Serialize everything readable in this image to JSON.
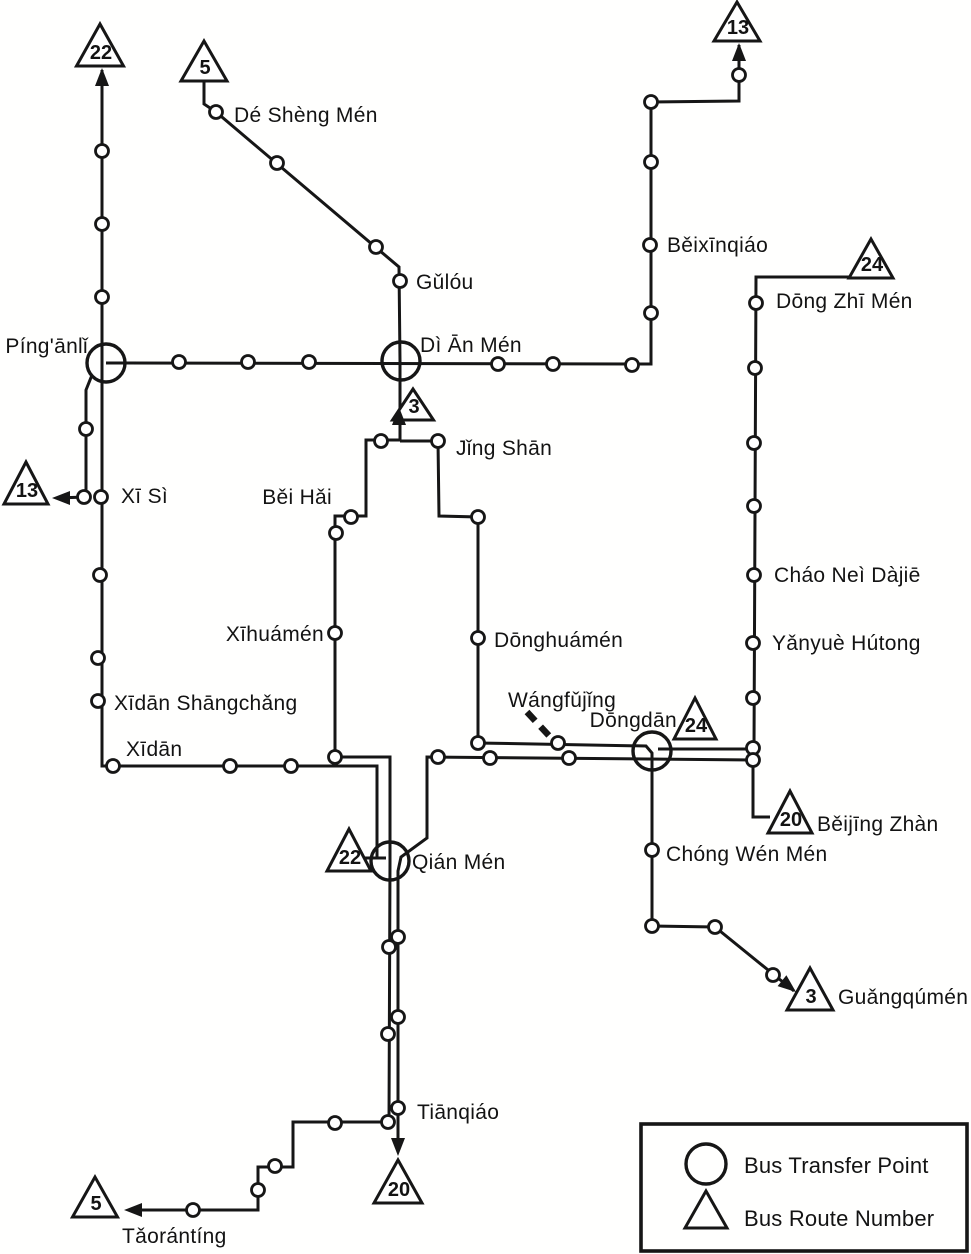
{
  "title": "Beijing Bus Routes Map",
  "ink_color": "#161616",
  "legend": {
    "transfer_label": "Bus Transfer Point",
    "route_label": "Bus Route Number",
    "box": {
      "x": 641,
      "y": 1124,
      "w": 326,
      "h": 127
    },
    "circle": {
      "x": 706,
      "y": 1164,
      "r": 20
    },
    "triangle": {
      "cx": 706,
      "base_y": 1228,
      "w": 42,
      "h": 37
    },
    "transfer_text_pos": {
      "x": 744,
      "y": 1173
    },
    "route_text_pos": {
      "x": 744,
      "y": 1226
    }
  },
  "map": {
    "width": 971,
    "height": 1254,
    "lines": [
      {
        "id": "route-22-main",
        "points": [
          [
            102,
            70
          ],
          [
            102,
            766
          ],
          [
            377,
            766
          ],
          [
            377,
            858
          ]
        ]
      },
      {
        "id": "route-22-qianmen-tick",
        "points": [
          [
            358,
            858
          ],
          [
            386,
            858
          ]
        ]
      },
      {
        "id": "route-5-north",
        "points": [
          [
            204,
            82
          ],
          [
            204,
            104
          ],
          [
            216,
            112
          ],
          [
            399,
            267
          ],
          [
            400,
            361
          ],
          [
            400,
            441
          ]
        ]
      },
      {
        "id": "route-5-south",
        "points": [
          [
            400,
            440
          ],
          [
            366,
            440
          ],
          [
            366,
            516
          ],
          [
            335,
            516
          ],
          [
            335,
            757
          ],
          [
            390,
            757
          ],
          [
            390,
            861
          ],
          [
            389,
            1122
          ],
          [
            293,
            1122
          ],
          [
            293,
            1167
          ],
          [
            258,
            1167
          ],
          [
            258,
            1210
          ],
          [
            128,
            1210
          ]
        ]
      },
      {
        "id": "route-3",
        "points": [
          [
            400,
            441
          ],
          [
            438,
            441
          ],
          [
            439,
            516
          ],
          [
            478,
            517
          ],
          [
            478,
            743
          ],
          [
            646,
            746
          ],
          [
            652,
            753
          ],
          [
            652,
            926
          ],
          [
            715,
            927
          ],
          [
            794,
            991
          ]
        ]
      },
      {
        "id": "route-20",
        "points": [
          [
            770,
            817
          ],
          [
            753,
            817
          ],
          [
            753,
            760
          ],
          [
            427,
            757
          ],
          [
            427,
            838
          ],
          [
            401,
            857
          ],
          [
            398,
            871
          ],
          [
            398,
            1150
          ]
        ]
      },
      {
        "id": "route-24",
        "points": [
          [
            849,
            277
          ],
          [
            756,
            277
          ],
          [
            754,
            749
          ],
          [
            658,
            749
          ]
        ]
      },
      {
        "id": "route-13-main",
        "points": [
          [
            739,
            45
          ],
          [
            739,
            101
          ],
          [
            651,
            102
          ],
          [
            651,
            364
          ],
          [
            106,
            363
          ]
        ]
      },
      {
        "id": "route-13-west-branch",
        "points": [
          [
            92,
            375
          ],
          [
            86,
            390
          ],
          [
            86,
            497
          ],
          [
            56,
            498
          ]
        ]
      }
    ],
    "dashes": [
      {
        "id": "wangfujing-pointer",
        "points": [
          [
            527,
            712
          ],
          [
            553,
            740
          ]
        ]
      }
    ],
    "stops": [
      {
        "x": 102,
        "y": 151
      },
      {
        "x": 102,
        "y": 224
      },
      {
        "x": 102,
        "y": 297
      },
      {
        "x": 179,
        "y": 362
      },
      {
        "x": 248,
        "y": 362
      },
      {
        "x": 309,
        "y": 362
      },
      {
        "x": 498,
        "y": 364
      },
      {
        "x": 553,
        "y": 364
      },
      {
        "x": 632,
        "y": 365
      },
      {
        "x": 216,
        "y": 112
      },
      {
        "x": 277,
        "y": 163
      },
      {
        "x": 376,
        "y": 247
      },
      {
        "x": 400,
        "y": 281
      },
      {
        "x": 739,
        "y": 75
      },
      {
        "x": 651,
        "y": 102
      },
      {
        "x": 651,
        "y": 162
      },
      {
        "x": 650,
        "y": 245
      },
      {
        "x": 651,
        "y": 313
      },
      {
        "x": 756,
        "y": 303
      },
      {
        "x": 755,
        "y": 368
      },
      {
        "x": 754,
        "y": 443
      },
      {
        "x": 754,
        "y": 506
      },
      {
        "x": 754,
        "y": 575
      },
      {
        "x": 753,
        "y": 643
      },
      {
        "x": 753,
        "y": 698
      },
      {
        "x": 753,
        "y": 748
      },
      {
        "x": 753,
        "y": 760
      },
      {
        "x": 86,
        "y": 429
      },
      {
        "x": 84,
        "y": 497
      },
      {
        "x": 101,
        "y": 497
      },
      {
        "x": 100,
        "y": 575
      },
      {
        "x": 98,
        "y": 658
      },
      {
        "x": 98,
        "y": 701
      },
      {
        "x": 113,
        "y": 766
      },
      {
        "x": 230,
        "y": 766
      },
      {
        "x": 291,
        "y": 766
      },
      {
        "x": 381,
        "y": 441
      },
      {
        "x": 438,
        "y": 441
      },
      {
        "x": 351,
        "y": 517
      },
      {
        "x": 478,
        "y": 517
      },
      {
        "x": 336,
        "y": 533
      },
      {
        "x": 335,
        "y": 633
      },
      {
        "x": 478,
        "y": 638
      },
      {
        "x": 335,
        "y": 757
      },
      {
        "x": 478,
        "y": 743
      },
      {
        "x": 558,
        "y": 743
      },
      {
        "x": 438,
        "y": 757
      },
      {
        "x": 490,
        "y": 758
      },
      {
        "x": 569,
        "y": 758
      },
      {
        "x": 398,
        "y": 937
      },
      {
        "x": 389,
        "y": 947
      },
      {
        "x": 398,
        "y": 1017
      },
      {
        "x": 388,
        "y": 1034
      },
      {
        "x": 398,
        "y": 1108
      },
      {
        "x": 388,
        "y": 1122
      },
      {
        "x": 335,
        "y": 1123
      },
      {
        "x": 275,
        "y": 1166
      },
      {
        "x": 258,
        "y": 1190
      },
      {
        "x": 193,
        "y": 1210
      },
      {
        "x": 652,
        "y": 850
      },
      {
        "x": 652,
        "y": 926
      },
      {
        "x": 715,
        "y": 927
      },
      {
        "x": 773,
        "y": 975
      }
    ],
    "transfers": [
      {
        "id": "pinganli",
        "x": 106,
        "y": 363,
        "r": 19
      },
      {
        "id": "dianmen",
        "x": 401,
        "y": 361,
        "r": 19
      },
      {
        "id": "dongdan",
        "x": 652,
        "y": 751,
        "r": 19
      },
      {
        "id": "qianmen",
        "x": 390,
        "y": 861,
        "r": 19
      }
    ],
    "triangles": [
      {
        "id": "route-22-north-end",
        "cx": 100,
        "base_y": 66,
        "w": 47,
        "h": 42,
        "num": "22"
      },
      {
        "id": "route-5-north-end",
        "cx": 204,
        "base_y": 81,
        "w": 46,
        "h": 40,
        "num": "5"
      },
      {
        "id": "route-13-north-end",
        "cx": 737,
        "base_y": 41,
        "w": 46,
        "h": 39,
        "num": "13"
      },
      {
        "id": "route-24-north-end",
        "cx": 871,
        "base_y": 278,
        "w": 44,
        "h": 39,
        "num": "24"
      },
      {
        "id": "route-13-west-end",
        "cx": 26,
        "base_y": 504,
        "w": 44,
        "h": 42,
        "num": "13"
      },
      {
        "id": "route-3-dianmen-end",
        "cx": 413,
        "base_y": 420,
        "w": 41,
        "h": 31,
        "num": "3"
      },
      {
        "id": "route-24-dongdan-end",
        "cx": 695,
        "base_y": 739,
        "w": 42,
        "h": 41,
        "num": "24"
      },
      {
        "id": "route-20-beijingzhan-end",
        "cx": 790,
        "base_y": 833,
        "w": 44,
        "h": 42,
        "num": "20"
      },
      {
        "id": "route-22-qianmen-end",
        "cx": 349,
        "base_y": 871,
        "w": 44,
        "h": 42,
        "num": "22"
      },
      {
        "id": "route-3-guangqumen-end",
        "cx": 810,
        "base_y": 1010,
        "w": 46,
        "h": 42,
        "num": "3"
      },
      {
        "id": "route-20-tianqiao-end",
        "cx": 398,
        "base_y": 1203,
        "w": 48,
        "h": 43,
        "num": "20"
      },
      {
        "id": "route-5-taoranting-end",
        "cx": 95,
        "base_y": 1217,
        "w": 45,
        "h": 40,
        "num": "5"
      }
    ],
    "arrows": [
      {
        "x": 102,
        "y": 68,
        "a": -90
      },
      {
        "x": 739,
        "y": 43,
        "a": -90
      },
      {
        "x": 52,
        "y": 498,
        "a": 180
      },
      {
        "x": 399,
        "y": 407,
        "a": -90
      },
      {
        "x": 796,
        "y": 992,
        "a": 39
      },
      {
        "x": 398,
        "y": 1156,
        "a": 90
      },
      {
        "x": 124,
        "y": 1210,
        "a": 180
      }
    ],
    "labels": [
      {
        "text": "Dé Shèng Mén",
        "x": 234,
        "y": 122,
        "anchor": "start"
      },
      {
        "text": "Gǔlóu",
        "x": 416,
        "y": 289,
        "anchor": "start"
      },
      {
        "text": "Dì Ān Mén",
        "x": 420,
        "y": 352,
        "anchor": "start"
      },
      {
        "text": "Píng'ānlǐ",
        "x": 88,
        "y": 353,
        "anchor": "end"
      },
      {
        "text": "Běixīnqiáo",
        "x": 667,
        "y": 252,
        "anchor": "start"
      },
      {
        "text": "Dōng Zhī Mén",
        "x": 776,
        "y": 308,
        "anchor": "start"
      },
      {
        "text": "Cháo Neì Dàjiē",
        "x": 774,
        "y": 582,
        "anchor": "start"
      },
      {
        "text": "Yǎnyuè Hútong",
        "x": 772,
        "y": 650,
        "anchor": "start"
      },
      {
        "text": "Jǐng Shān",
        "x": 456,
        "y": 455,
        "anchor": "start"
      },
      {
        "text": "Běi Hǎi",
        "x": 332,
        "y": 504,
        "anchor": "end"
      },
      {
        "text": "Xī Sì",
        "x": 121,
        "y": 503,
        "anchor": "start"
      },
      {
        "text": "Xīhuámén",
        "x": 324,
        "y": 641,
        "anchor": "end"
      },
      {
        "text": "Dōnghuámén",
        "x": 494,
        "y": 647,
        "anchor": "start"
      },
      {
        "text": "Xīdān Shāngchǎng",
        "x": 114,
        "y": 710,
        "anchor": "start"
      },
      {
        "text": "Xīdān",
        "x": 126,
        "y": 756,
        "anchor": "start"
      },
      {
        "text": "Wángfǔjǐng",
        "x": 508,
        "y": 707,
        "anchor": "start"
      },
      {
        "text": "Dōngdān",
        "x": 677,
        "y": 727,
        "anchor": "end"
      },
      {
        "text": "Qián Mén",
        "x": 412,
        "y": 869,
        "anchor": "start"
      },
      {
        "text": "Chóng Wén Mén",
        "x": 666,
        "y": 861,
        "anchor": "start"
      },
      {
        "text": "Běijīng Zhàn",
        "x": 817,
        "y": 831,
        "anchor": "start"
      },
      {
        "text": "Guǎngqúmén",
        "x": 838,
        "y": 1004,
        "anchor": "start"
      },
      {
        "text": "Tiānqiáo",
        "x": 417,
        "y": 1119,
        "anchor": "start"
      },
      {
        "text": "Tǎorántíng",
        "x": 122,
        "y": 1243,
        "anchor": "start"
      }
    ]
  }
}
